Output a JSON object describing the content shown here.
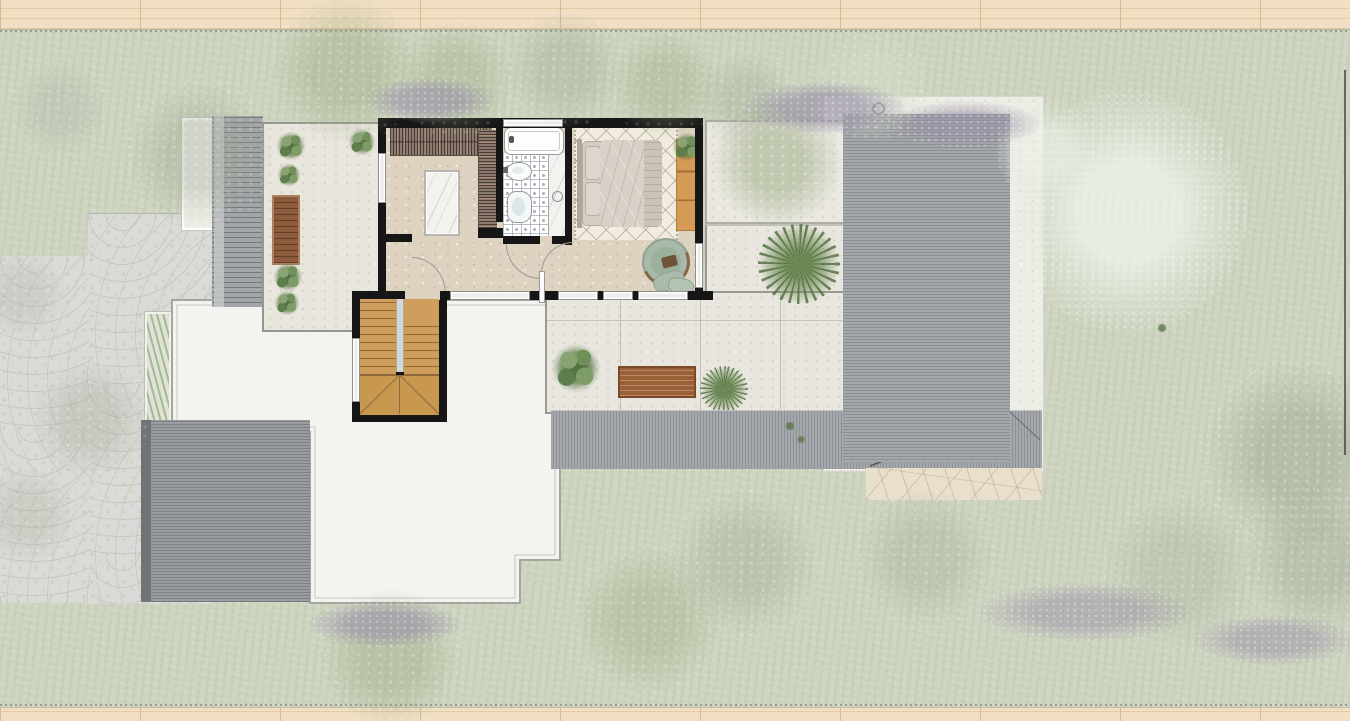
{
  "meta": {
    "kind": "architectural-site-plan",
    "view": "top-down rendered floor plan, upper level of a house with terraces, roofs and garden",
    "visible_text": "none"
  },
  "palette": {
    "lawn": "#cdd4bf",
    "wood_deck": "#f0dfc3",
    "cobblestone": "#dadad6",
    "white_flat_roof": "#f3f3f0",
    "metal_roof": "#9b9ea2",
    "garage_roof": "#979a9d",
    "wall_black": "#161616",
    "interior_floor": "#ded3c1",
    "terrace_concrete": "#e9e6df",
    "bathroom_tile": "#aab0bc",
    "marble": "#f4f2ef",
    "stair_wood": "#cf9d5c",
    "bench_wood": "#8e5a3d",
    "desk_wood": "#d59a55",
    "plant_green": "#5e7f4c",
    "armchair_sage": "#a8b9ab",
    "lavender": "#9890a8",
    "stone_paving": "#e9dfcd"
  },
  "rooms": [
    {
      "name": "walk-in-wardrobe"
    },
    {
      "name": "bathroom"
    },
    {
      "name": "bedroom"
    },
    {
      "name": "hallway"
    },
    {
      "name": "staircase"
    },
    {
      "name": "left-terrace"
    },
    {
      "name": "main-terrace"
    }
  ],
  "icons": [
    {
      "name": "outdoor-shower-icon",
      "shape": "circle-on-stem with spray ticks"
    }
  ],
  "fixtures": [
    "bathtub",
    "sink",
    "toilet",
    "double-bed",
    "rug",
    "desk",
    "armchair",
    "wardrobe-closets",
    "marble-island",
    "benches",
    "potted-plants"
  ]
}
